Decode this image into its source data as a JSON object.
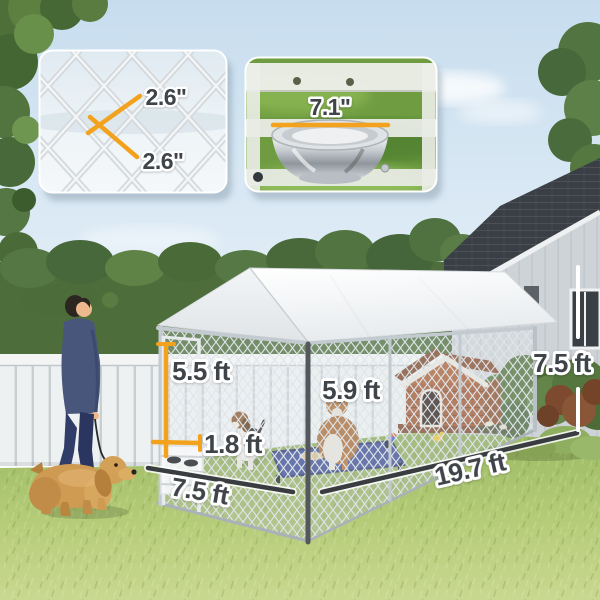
{
  "image": {
    "width": 600,
    "height": 600,
    "description": "Backyard scene: walk-in outdoor dog kennel with white canopy roof and chain-link walls, dog house and two dogs inside, man walking a cocker spaniel, two detail insets and dimension annotations."
  },
  "insets": {
    "mesh": {
      "name": "chain-link-opening-closeup",
      "label_top": "2.6\"",
      "label_bottom": "2.6\""
    },
    "bowl": {
      "name": "hanging-bowl-closeup",
      "label": "7.1\""
    }
  },
  "dimensions": {
    "door_height": "5.5 ft",
    "door_width": "1.8 ft",
    "front_width": "7.5 ft",
    "interior_height": "5.9 ft",
    "length": "19.7 ft",
    "overall_height": "7.5 ft"
  },
  "colors": {
    "accent_orange": "#F2A21C",
    "dimension_dark": "#3A3D40",
    "dimension_white": "#FFFFFF",
    "label_text": "#3F4449",
    "sky": "#C9DFF0",
    "grass": "#AFC96E",
    "canopy_white": "#F7F9FA",
    "frame_gray": "#C3CAD0",
    "fence_white": "#EEF1F2",
    "hedge_green": "#4D6D3A",
    "house_wall": "#CCD2D5",
    "house_roof": "#3A3F45",
    "dog_house_brown": "#A05631",
    "cot_blue": "#3C4C92"
  }
}
